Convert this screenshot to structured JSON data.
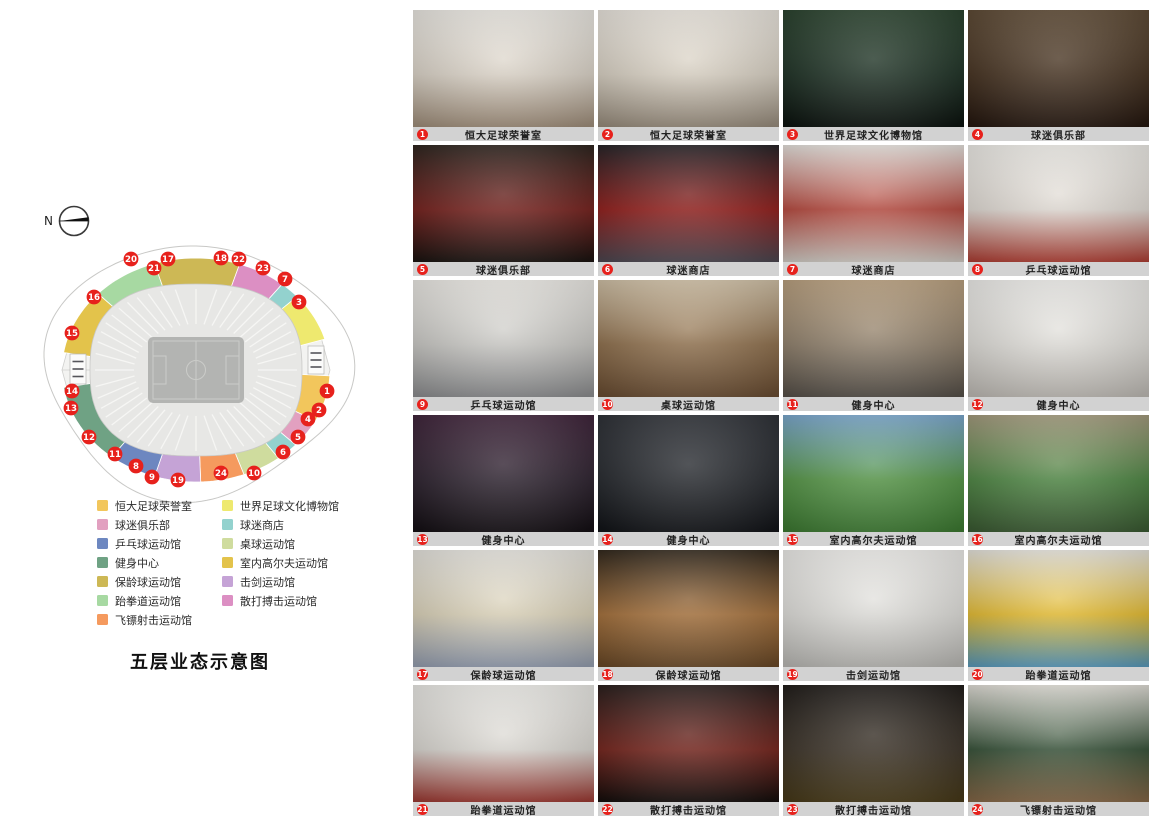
{
  "page_title": "五层业态示意图",
  "compass": {
    "label": "N"
  },
  "legend": {
    "columns": [
      {
        "items": [
          {
            "label": "恒大足球荣誉室",
            "color": "#f2c65c"
          },
          {
            "label": "球迷俱乐部",
            "color": "#e2a0c0"
          },
          {
            "label": "乒乓球运动馆",
            "color": "#6d87c0"
          },
          {
            "label": "健身中心",
            "color": "#6fa284"
          },
          {
            "label": "保龄球运动馆",
            "color": "#cdb855"
          },
          {
            "label": "跆拳道运动馆",
            "color": "#a7d9a2"
          },
          {
            "label": "飞镖射击运动馆",
            "color": "#f59a5e"
          }
        ]
      },
      {
        "items": [
          {
            "label": "世界足球文化博物馆",
            "color": "#eee96f"
          },
          {
            "label": "球迷商店",
            "color": "#93d2ce"
          },
          {
            "label": "桌球运动馆",
            "color": "#cfdc9e"
          },
          {
            "label": "室内高尔夫运动馆",
            "color": "#e3c34b"
          },
          {
            "label": "击剑运动馆",
            "color": "#c5a3d6"
          },
          {
            "label": "散打搏击运动馆",
            "color": "#dc8fc3"
          }
        ]
      }
    ]
  },
  "plan": {
    "zones": [
      {
        "name": "室内高尔夫运动馆",
        "color": "#e3c34b",
        "a1": 137,
        "a2": 171
      },
      {
        "name": "跆拳道运动馆",
        "color": "#a7d9a2",
        "a1": 108,
        "a2": 137
      },
      {
        "name": "保龄球运动馆",
        "color": "#cdb855",
        "a1": 71,
        "a2": 108
      },
      {
        "name": "散打搏击运动馆",
        "color": "#dc8fc3",
        "a1": 50,
        "a2": 71
      },
      {
        "name": "球迷商店",
        "color": "#93d2ce",
        "a1": 41,
        "a2": 50
      },
      {
        "name": "世界足球文化博物馆",
        "color": "#eee96f",
        "a1": 16,
        "a2": 41
      },
      {
        "name": "恒大足球荣誉室",
        "color": "#f2c65c",
        "a1": -27,
        "a2": -3
      },
      {
        "name": "球迷俱乐部",
        "color": "#e2a0c0",
        "a1": -42,
        "a2": -27
      },
      {
        "name": "球迷商店",
        "color": "#93d2ce",
        "a1": -52,
        "a2": -42
      },
      {
        "name": "桌球运动馆",
        "color": "#cfdc9e",
        "a1": -69,
        "a2": -52
      },
      {
        "name": "飞镖射击运动馆",
        "color": "#f59a5e",
        "a1": -88,
        "a2": -69
      },
      {
        "name": "击剑运动馆",
        "color": "#c5a3d6",
        "a1": -108,
        "a2": -88
      },
      {
        "name": "乒乓球运动馆",
        "color": "#6d87c0",
        "a1": -129,
        "a2": -108
      },
      {
        "name": "健身中心",
        "color": "#6fa284",
        "a1": -171,
        "a2": -129
      }
    ],
    "markers": [
      {
        "n": "1",
        "x": 291,
        "y": 151
      },
      {
        "n": "2",
        "x": 283,
        "y": 170
      },
      {
        "n": "3",
        "x": 263,
        "y": 62
      },
      {
        "n": "4",
        "x": 272,
        "y": 179
      },
      {
        "n": "5",
        "x": 262,
        "y": 197
      },
      {
        "n": "6",
        "x": 247,
        "y": 212
      },
      {
        "n": "7",
        "x": 249,
        "y": 39
      },
      {
        "n": "8",
        "x": 100,
        "y": 226
      },
      {
        "n": "9",
        "x": 116,
        "y": 237
      },
      {
        "n": "10",
        "x": 218,
        "y": 233
      },
      {
        "n": "11",
        "x": 79,
        "y": 214
      },
      {
        "n": "12",
        "x": 53,
        "y": 197
      },
      {
        "n": "13",
        "x": 35,
        "y": 168
      },
      {
        "n": "14",
        "x": 36,
        "y": 151
      },
      {
        "n": "15",
        "x": 36,
        "y": 93
      },
      {
        "n": "16",
        "x": 58,
        "y": 57
      },
      {
        "n": "17",
        "x": 132,
        "y": 19
      },
      {
        "n": "18",
        "x": 185,
        "y": 18
      },
      {
        "n": "19",
        "x": 142,
        "y": 240
      },
      {
        "n": "20",
        "x": 95,
        "y": 19
      },
      {
        "n": "21",
        "x": 118,
        "y": 28
      },
      {
        "n": "22",
        "x": 203,
        "y": 19
      },
      {
        "n": "23",
        "x": 227,
        "y": 28
      },
      {
        "n": "24",
        "x": 185,
        "y": 233
      }
    ],
    "marker_color": "#e7211c"
  },
  "gallery": [
    {
      "num": "1",
      "label": "恒大足球荣誉室",
      "palette": [
        "#efece6",
        "#d9d1c5",
        "#a3917d"
      ]
    },
    {
      "num": "2",
      "label": "恒大足球荣誉室",
      "palette": [
        "#eee9e1",
        "#d6cec0",
        "#9b8f7f"
      ]
    },
    {
      "num": "3",
      "label": "世界足球文化博物馆",
      "palette": [
        "#27402b",
        "#15291c",
        "#0d1410"
      ]
    },
    {
      "num": "4",
      "label": "球迷俱乐部",
      "palette": [
        "#5c4832",
        "#3e2a18",
        "#261810"
      ]
    },
    {
      "num": "5",
      "label": "球迷俱乐部",
      "palette": [
        "#2a211b",
        "#6e1713",
        "#1b1512"
      ]
    },
    {
      "num": "6",
      "label": "球迷商店",
      "palette": [
        "#232024",
        "#8c1512",
        "#4e4953"
      ]
    },
    {
      "num": "7",
      "label": "球迷商店",
      "palette": [
        "#e9e5e0",
        "#b24237",
        "#d6d1ca"
      ]
    },
    {
      "num": "8",
      "label": "乒乓球运动馆",
      "palette": [
        "#f2f0eb",
        "#ded8d1",
        "#b23f34"
      ]
    },
    {
      "num": "9",
      "label": "乒乓球运动馆",
      "palette": [
        "#efede8",
        "#c7c6c2",
        "#8f9092"
      ]
    },
    {
      "num": "10",
      "label": "桌球运动馆",
      "palette": [
        "#d2c2a7",
        "#8a6a46",
        "#6b4e33"
      ]
    },
    {
      "num": "11",
      "label": "健身中心",
      "palette": [
        "#bba17f",
        "#8b7b66",
        "#58524b"
      ]
    },
    {
      "num": "12",
      "label": "健身中心",
      "palette": [
        "#f2f1ee",
        "#dedcd7",
        "#c3bfb9"
      ]
    },
    {
      "num": "13",
      "label": "健身中心",
      "palette": [
        "#3d2138",
        "#251a27",
        "#151015"
      ]
    },
    {
      "num": "14",
      "label": "健身中心",
      "palette": [
        "#2b2e34",
        "#1e2126",
        "#131519"
      ]
    },
    {
      "num": "15",
      "label": "室内高尔夫运动馆",
      "palette": [
        "#7aa8d0",
        "#4f9140",
        "#3e7c33"
      ]
    },
    {
      "num": "16",
      "label": "室内高尔夫运动馆",
      "palette": [
        "#a49b7d",
        "#47813c",
        "#3c5c34"
      ]
    },
    {
      "num": "17",
      "label": "保龄球运动馆",
      "palette": [
        "#e9e7e1",
        "#d9d0b6",
        "#98a2b5"
      ]
    },
    {
      "num": "18",
      "label": "保龄球运动馆",
      "palette": [
        "#2f2519",
        "#a06a33",
        "#6b4a28"
      ]
    },
    {
      "num": "19",
      "label": "击剑运动馆",
      "palette": [
        "#f1f0ed",
        "#dddcd8",
        "#bebdb9"
      ]
    },
    {
      "num": "20",
      "label": "跆拳道运动馆",
      "palette": [
        "#e9e7e0",
        "#e3b92a",
        "#5a9ec2"
      ]
    },
    {
      "num": "21",
      "label": "跆拳道运动馆",
      "palette": [
        "#efeeea",
        "#d8d5cf",
        "#a03a33"
      ]
    },
    {
      "num": "22",
      "label": "散打搏击运动馆",
      "palette": [
        "#261b19",
        "#6e1b13",
        "#150f0d"
      ]
    },
    {
      "num": "23",
      "label": "散打搏击运动馆",
      "palette": [
        "#1d1916",
        "#342b20",
        "#4a3c1a"
      ]
    },
    {
      "num": "24",
      "label": "飞镖射击运动馆",
      "palette": [
        "#e5e2db",
        "#2e4a30",
        "#8a6b4a"
      ]
    }
  ]
}
